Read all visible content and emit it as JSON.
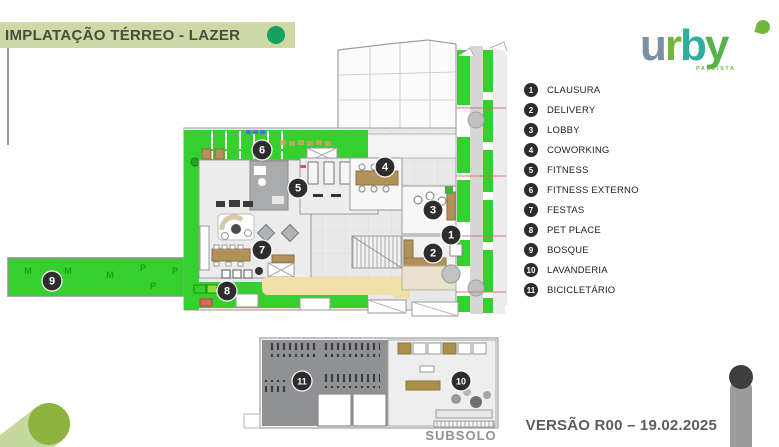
{
  "slide": {
    "title": "IMPLATAÇÃO TÉRREO - LAZER",
    "version_label": "VERSÃO R00 – 19.02.2025",
    "subsolo_label": "SUBSOLO"
  },
  "logo": {
    "word": "urby",
    "sub": "PAULISTA",
    "letters": [
      {
        "ch": "u",
        "color": "#7b8fa5"
      },
      {
        "ch": "r",
        "color": "#72b73c"
      },
      {
        "ch": "b",
        "color": "#2fada0"
      },
      {
        "ch": "y",
        "color": "#55b24a"
      }
    ]
  },
  "legend": {
    "items": [
      {
        "num": "1",
        "label": "CLAUSURA"
      },
      {
        "num": "2",
        "label": "DELIVERY"
      },
      {
        "num": "3",
        "label": "LOBBY"
      },
      {
        "num": "4",
        "label": "COWORKING"
      },
      {
        "num": "5",
        "label": "FITNESS"
      },
      {
        "num": "6",
        "label": "FITNESS EXTERNO"
      },
      {
        "num": "7",
        "label": "FESTAS"
      },
      {
        "num": "8",
        "label": "PET PLACE"
      },
      {
        "num": "9",
        "label": "BOSQUE"
      },
      {
        "num": "10",
        "label": "LAVANDERIA"
      },
      {
        "num": "11",
        "label": "BICICLETÁRIO"
      }
    ]
  },
  "plan": {
    "markers": [
      {
        "num": "1",
        "x": 451,
        "y": 235
      },
      {
        "num": "2",
        "x": 433,
        "y": 253
      },
      {
        "num": "3",
        "x": 433,
        "y": 210
      },
      {
        "num": "4",
        "x": 385,
        "y": 167
      },
      {
        "num": "5",
        "x": 298,
        "y": 188
      },
      {
        "num": "6",
        "x": 262,
        "y": 150
      },
      {
        "num": "7",
        "x": 262,
        "y": 250
      },
      {
        "num": "8",
        "x": 227,
        "y": 291
      },
      {
        "num": "9",
        "x": 52,
        "y": 281
      }
    ],
    "bosque_letters": [
      {
        "t": "M",
        "x": 28,
        "y": 274
      },
      {
        "t": "M",
        "x": 68,
        "y": 274
      },
      {
        "t": "M",
        "x": 110,
        "y": 278
      },
      {
        "t": "P",
        "x": 143,
        "y": 271
      },
      {
        "t": "P",
        "x": 175,
        "y": 274
      },
      {
        "t": "P",
        "x": 153,
        "y": 289
      }
    ]
  },
  "subsolo": {
    "markers": [
      {
        "num": "11",
        "x": 302,
        "y": 381
      },
      {
        "num": "10",
        "x": 461,
        "y": 381
      }
    ]
  },
  "colors": {
    "green": "#35cf2e",
    "green_dark": "#1d9e17",
    "title_bar": "#ccd8a5",
    "title_text": "#44503c",
    "accent_dot": "#17a05f",
    "marker_bg": "#2d2d2d",
    "wood": "#b3925a",
    "sand": "#f0dfa6",
    "swoosh": "#8cb43f",
    "subsolo_dark": "#8f9194",
    "version_text": "#5c5c5c"
  }
}
